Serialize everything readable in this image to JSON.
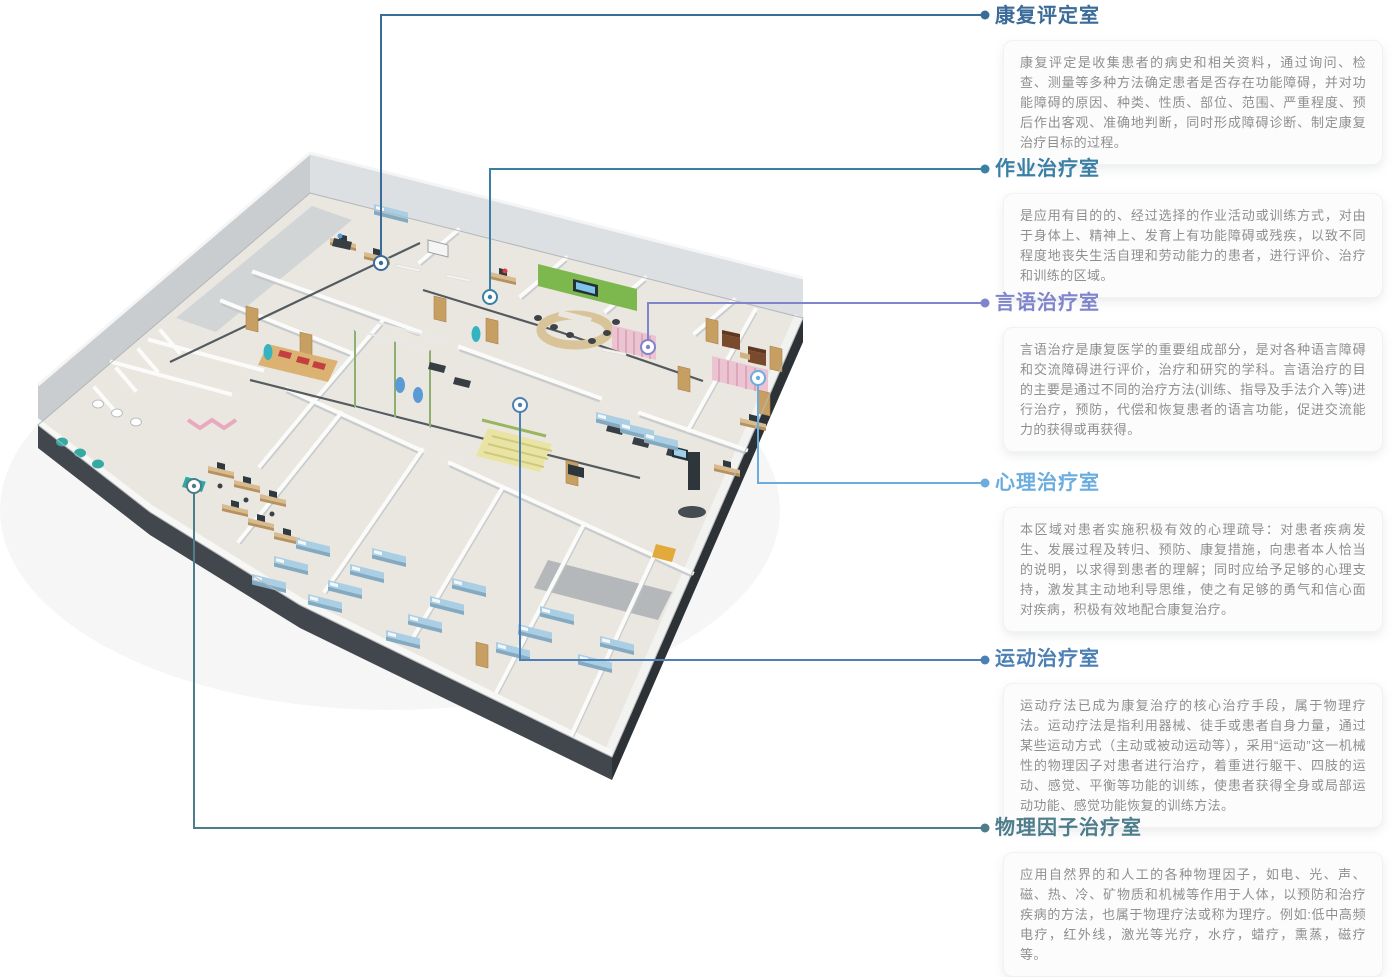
{
  "sections": [
    {
      "title": "康复评定室",
      "color": "#3a6b99",
      "description": "康复评定是收集患者的病史和相关资料，通过询问、检查、测量等多种方法确定患者是否存在功能障碍，并对功能障碍的原因、种类、性质、部位、范围、严重程度、预后作出客观、准确地判断，同时形成障碍诊断、制定康复治疗目标的过程。"
    },
    {
      "title": "作业治疗室",
      "color": "#3a7fa5",
      "description": "是应用有目的的、经过选择的作业活动或训练方式，对由于身体上、精神上、发育上有功能障碍或残疾，以致不同程度地丧失生活自理和劳动能力的患者，进行评价、治疗和训练的区域。"
    },
    {
      "title": "言语治疗室",
      "color": "#8084cb",
      "description": "言语治疗是康复医学的重要组成部分，是对各种语言障碍和交流障碍进行评价，治疗和研究的学科。言语治疗的目的主要是通过不同的治疗方法(训练、指导及手法介入等)进行治疗，预防，代偿和恢复患者的语言功能，促进交流能力的获得或再获得。"
    },
    {
      "title": "心理治疗室",
      "color": "#6badde",
      "description": "本区域对患者实施积极有效的心理疏导：对患者疾病发生、发展过程及转归、预防、康复措施，向患者本人恰当的说明，以求得到患者的理解；同时应给予足够的心理支持，激发其主动地利导思维，使之有足够的勇气和信心面对疾病，积极有效地配合康复治疗。"
    },
    {
      "title": "运动治疗室",
      "color": "#4c80b5",
      "description": "运动疗法已成为康复治疗的核心治疗手段，属于物理疗法。运动疗法是指利用器械、徒手或患者自身力量，通过某些运动方式（主动或被动运动等），采用“运动”这一机械性的物理因子对患者进行治疗，着重进行躯干、四肢的运动、感觉、平衡等功能的训练，使患者获得全身或局部运动功能、感觉功能恢复的训练方法。"
    },
    {
      "title": "物理因子治疗室",
      "color": "#4d7c8b",
      "description": "应用自然界的和人工的各种物理因子，如电、光、声、磁、热、冷、矿物质和机械等作用于人体，以预防和治疗疾病的方法，也属于物理疗法或称为理疗。例如:低中高频电疗，红外线，激光等光疗，水疗，蜡疗，熏蒸，磁疗等。"
    }
  ],
  "palette": {
    "card_background": "#fcfcfc",
    "body_text": "#8f8f8f",
    "floor": "#eae7e1",
    "bed_blue": "#aacfe5",
    "accent_green": "#7cb84d",
    "curtain_pink": "#ecc3d1",
    "wood": "#d2b183",
    "equipment_dark": "#3a4146",
    "marker_fill": "#ffffff"
  }
}
